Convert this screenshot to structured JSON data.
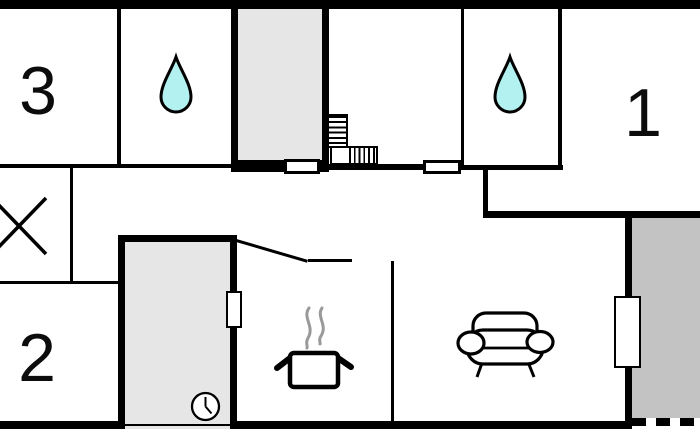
{
  "floorplan": {
    "rooms": {
      "bedroom_3": {
        "label": "3"
      },
      "bedroom_1": {
        "label": "1"
      },
      "bedroom_2": {
        "label": "2"
      },
      "bathroom_top": {
        "label": ""
      },
      "bathroom_right": {
        "label": ""
      },
      "kitchen": {
        "label": ""
      },
      "living_room": {
        "label": ""
      },
      "entry_hall": {
        "label": ""
      },
      "terrace": {
        "label": ""
      }
    },
    "icons": {
      "bathroom_top": "water-drop-icon",
      "bathroom_right": "water-drop-icon",
      "stair_room": "stairs-icon",
      "kitchen": "cooking-pot-icon",
      "kitchen_steam": "steam-icon",
      "living_room": "sofa-icon",
      "entry_hall": "clock-icon",
      "storage_room": "window-cross-icon"
    },
    "colors": {
      "wall": "#000000",
      "floor": "#ffffff",
      "hallway_fill": "#e6e6e6",
      "terrace_fill": "#c3c3c3",
      "water": "#b3f1f1",
      "steam": "#999999"
    }
  }
}
